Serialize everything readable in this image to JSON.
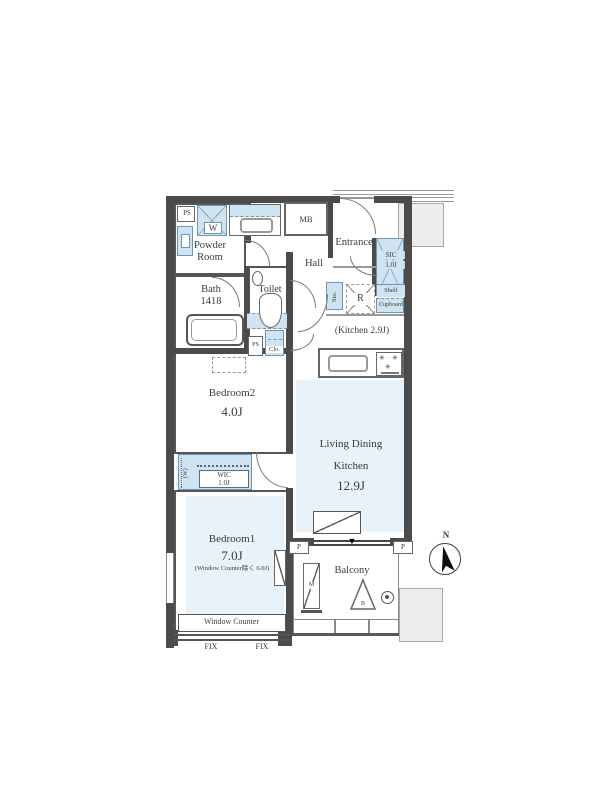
{
  "colors": {
    "fixture_blue": "#cfe3f1",
    "floor_blue": "#e9f2f9",
    "wall": "#4b4b4b",
    "gray_area": "#ededed"
  },
  "rooms": {
    "powder_room": {
      "line1": "Powder",
      "line2": "Room"
    },
    "bath": {
      "name": "Bath",
      "size": "1418"
    },
    "toilet": {
      "name": "Toilet"
    },
    "hall": {
      "name": "Hall"
    },
    "entrance": {
      "name": "Entrance"
    },
    "sic": {
      "name": "SIC",
      "size": "1.0J",
      "shelf": "Shelf"
    },
    "kitchen": {
      "label": "(Kitchen 2.9J)"
    },
    "ldk": {
      "line1": "Living Dining",
      "line2": "Kitchen",
      "size": "12.9J"
    },
    "bedroom2": {
      "name": "Bedroom2",
      "size": "4.0J"
    },
    "bedroom1": {
      "name": "Bedroom1",
      "size": "7.0J",
      "note": "(Window Counter除く 6.0J)"
    },
    "wic": {
      "name": "WIC",
      "size": "1.0J",
      "w_mark": "(W)"
    },
    "balcony": {
      "name": "Balcony"
    }
  },
  "fixtures": {
    "ps_top": "PS",
    "washer": "W",
    "meter_box": "MB",
    "storage": "Sto.",
    "refrigerator": "R",
    "cupboard": "Cupboard",
    "ps_mid": "PS",
    "closet": "Clo.",
    "window_counter": "Window Counter",
    "fix_left": "FIX",
    "fix_right": "FIX",
    "pillar_left": "P",
    "pillar_right": "P",
    "unit_m": "M",
    "unit_b": "B",
    "down_marker": "▼",
    "burner": "✳"
  },
  "compass": {
    "north_label": "N"
  }
}
